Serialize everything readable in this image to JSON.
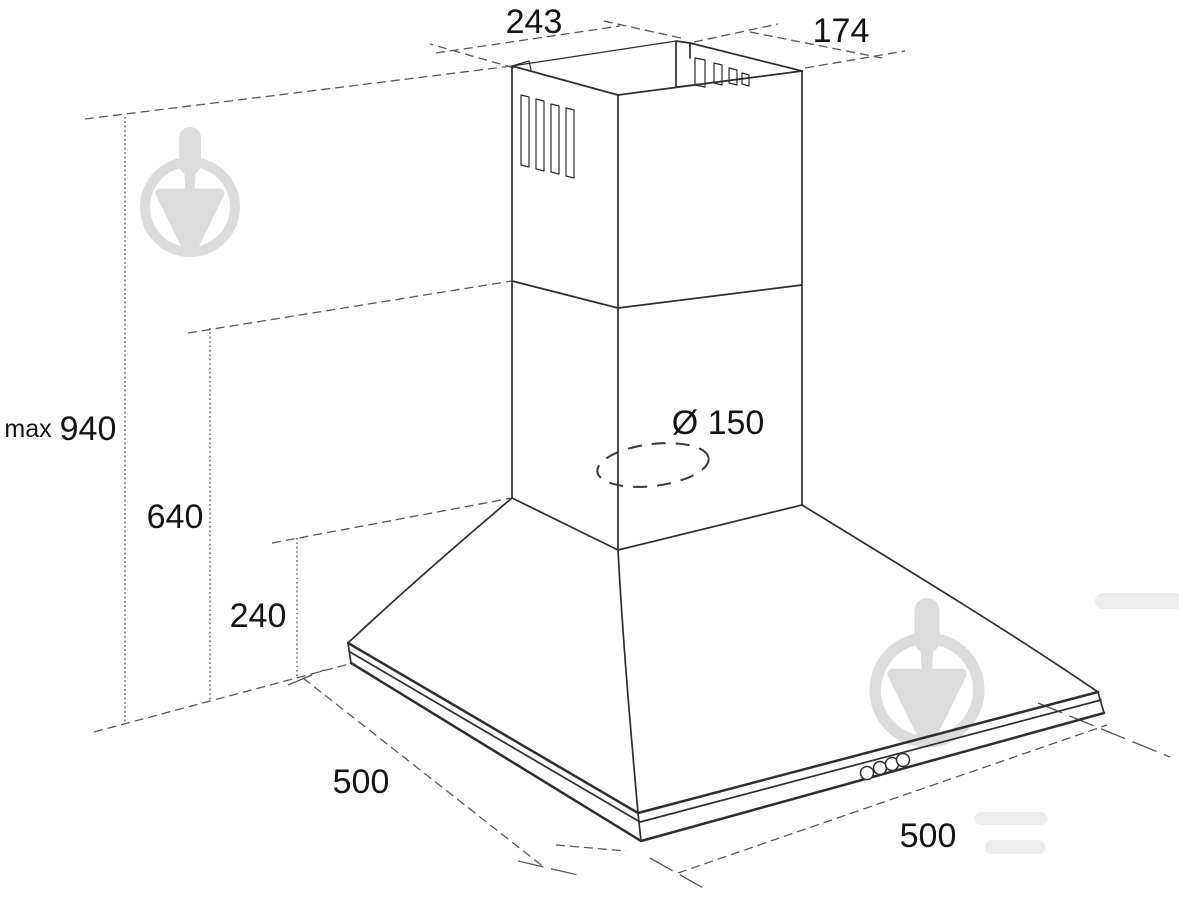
{
  "diagram": {
    "subject": "Dimensional isometric drawing of a wall-mounted chimney cooker hood",
    "labels": {
      "top_width": "243",
      "top_depth": "174",
      "max_height_prefix": "max",
      "max_height": "940",
      "chimney_height": "640",
      "hood_height": "240",
      "base_width": "500",
      "base_depth": "500",
      "duct_diameter": "Ø 150"
    },
    "controls": {
      "buttons_count": 4
    },
    "colors": {
      "outline": "#2e2e2e",
      "dimension": "#595959",
      "label": "#141414",
      "watermark": "#dcdcdc",
      "background": "#ffffff"
    }
  }
}
